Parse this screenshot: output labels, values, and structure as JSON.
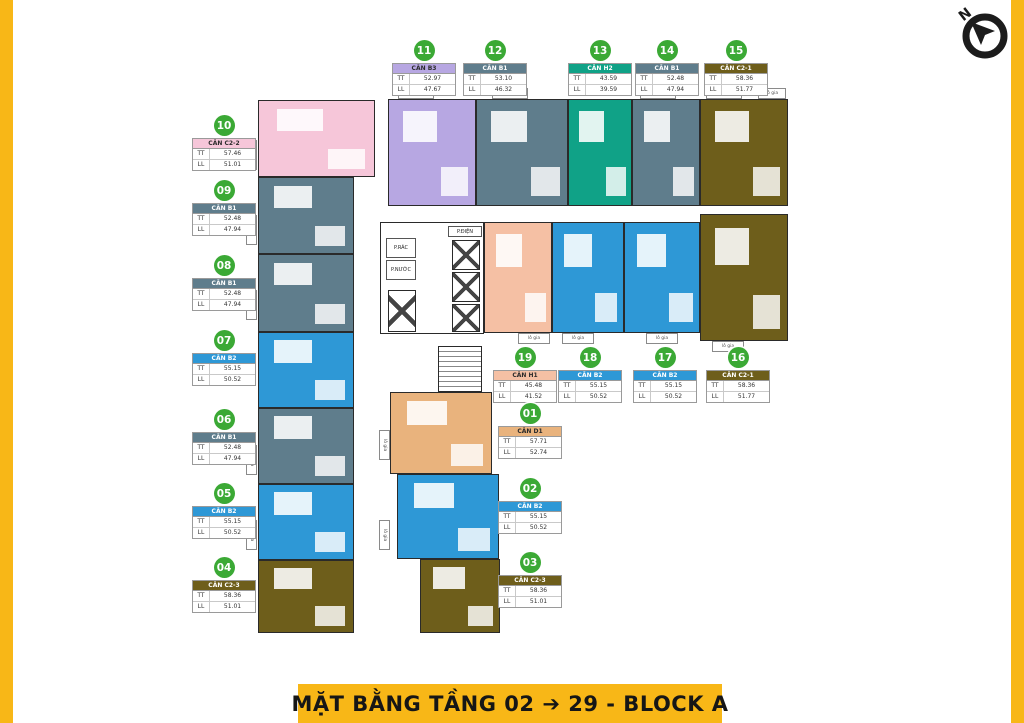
{
  "colors": {
    "accent_yellow": "#F8B717",
    "badge_green": "#3BA935",
    "wall_dark": "#2a2a2a"
  },
  "compass": {
    "n_label": "N"
  },
  "footer": {
    "title": "MẶT BẰNG TẦNG 02 ➔ 29 - BLOCK A"
  },
  "card": {
    "tt_label": "TT",
    "ll_label": "LL"
  },
  "plan_labels": {
    "lo_gia": "lô gia",
    "trash_room": "P.RÁC",
    "water_room": "P.NƯỚC",
    "electrical_room": "P.ĐIỆN"
  },
  "units": [
    {
      "no": "01",
      "name": "CĂN D1",
      "tt": "57.71",
      "ll": "52.74",
      "color": "#E9B37D",
      "text_color": "#2b2b2b"
    },
    {
      "no": "02",
      "name": "CĂN B2",
      "tt": "55.15",
      "ll": "50.52",
      "color": "#2E98D6",
      "text_color": "#ffffff"
    },
    {
      "no": "03",
      "name": "CĂN C2-3",
      "tt": "58.36",
      "ll": "51.01",
      "color": "#6E5E1B",
      "text_color": "#ffffff"
    },
    {
      "no": "04",
      "name": "CĂN C2-3",
      "tt": "58.36",
      "ll": "51.01",
      "color": "#6E5E1B",
      "text_color": "#ffffff"
    },
    {
      "no": "05",
      "name": "CĂN B2",
      "tt": "55.15",
      "ll": "50.52",
      "color": "#2E98D6",
      "text_color": "#ffffff"
    },
    {
      "no": "06",
      "name": "CĂN B1",
      "tt": "52.48",
      "ll": "47.94",
      "color": "#5F7D8C",
      "text_color": "#ffffff"
    },
    {
      "no": "07",
      "name": "CĂN B2",
      "tt": "55.15",
      "ll": "50.52",
      "color": "#2E98D6",
      "text_color": "#ffffff"
    },
    {
      "no": "08",
      "name": "CĂN B1",
      "tt": "52.48",
      "ll": "47.94",
      "color": "#5F7D8C",
      "text_color": "#ffffff"
    },
    {
      "no": "09",
      "name": "CĂN B1",
      "tt": "52.48",
      "ll": "47.94",
      "color": "#5F7D8C",
      "text_color": "#ffffff"
    },
    {
      "no": "10",
      "name": "CĂN C2-2",
      "tt": "57.46",
      "ll": "51.01",
      "color": "#F6C6D9",
      "text_color": "#2b2b2b"
    },
    {
      "no": "11",
      "name": "CĂN B3",
      "tt": "52.97",
      "ll": "47.67",
      "color": "#B7A7E2",
      "text_color": "#2b2b2b"
    },
    {
      "no": "12",
      "name": "CĂN B1",
      "tt": "53.10",
      "ll": "46.32",
      "color": "#5F7D8C",
      "text_color": "#ffffff"
    },
    {
      "no": "13",
      "name": "CĂN H2",
      "tt": "43.59",
      "ll": "39.59",
      "color": "#10A287",
      "text_color": "#ffffff"
    },
    {
      "no": "14",
      "name": "CĂN B1",
      "tt": "52.48",
      "ll": "47.94",
      "color": "#5F7D8C",
      "text_color": "#ffffff"
    },
    {
      "no": "15",
      "name": "CĂN C2-1",
      "tt": "58.36",
      "ll": "51.77",
      "color": "#6E5E1B",
      "text_color": "#ffffff"
    },
    {
      "no": "16",
      "name": "CĂN C2-1",
      "tt": "58.36",
      "ll": "51.77",
      "color": "#6E5E1B",
      "text_color": "#ffffff"
    },
    {
      "no": "17",
      "name": "CĂN B2",
      "tt": "55.15",
      "ll": "50.52",
      "color": "#2E98D6",
      "text_color": "#ffffff"
    },
    {
      "no": "18",
      "name": "CĂN B2",
      "tt": "55.15",
      "ll": "50.52",
      "color": "#2E98D6",
      "text_color": "#ffffff"
    },
    {
      "no": "19",
      "name": "CĂN H1",
      "tt": "45.48",
      "ll": "41.52",
      "color": "#F5C0A4",
      "text_color": "#2b2b2b"
    }
  ]
}
